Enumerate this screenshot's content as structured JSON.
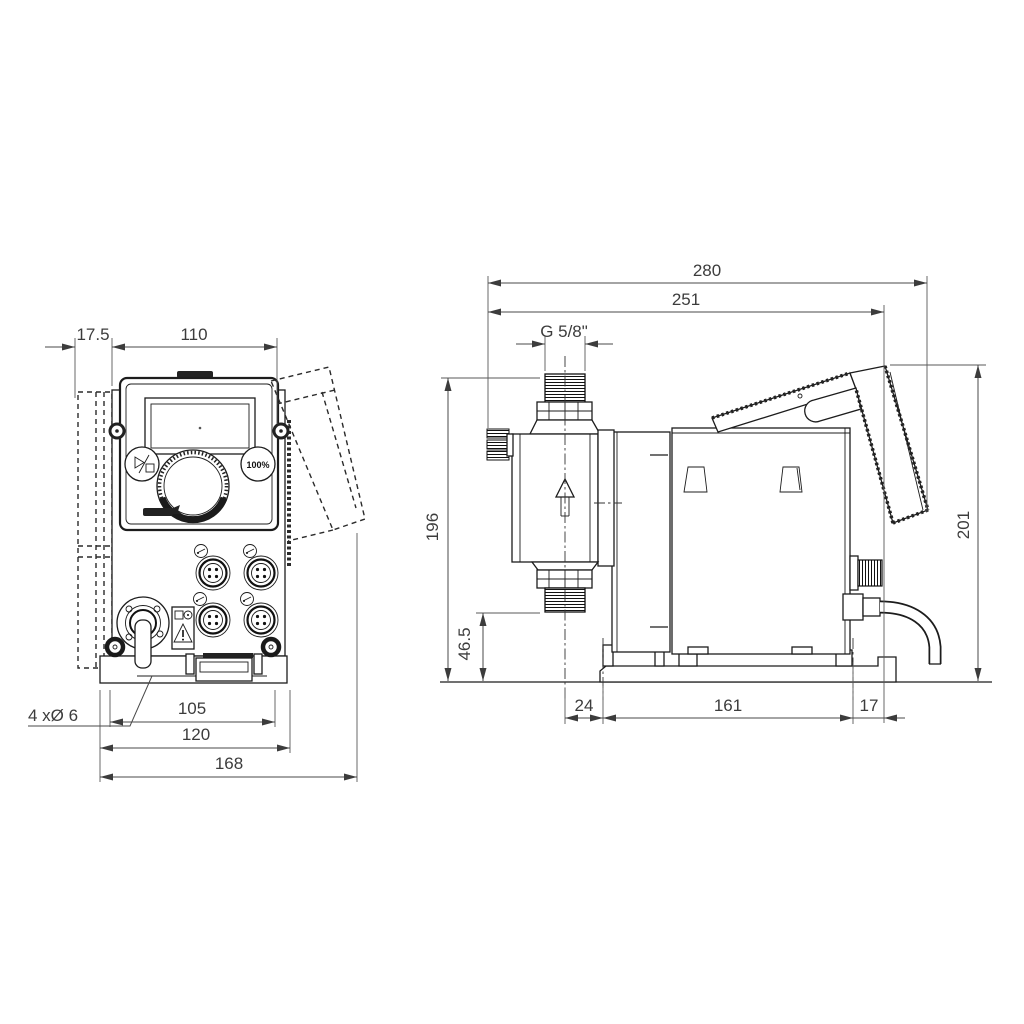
{
  "front_view": {
    "dim_wall_offset": "17.5",
    "dim_body_width": "110",
    "dim_hole_spacing": "105",
    "dim_plate_width": "120",
    "dim_total_width": "168",
    "mounting_holes_label": "4 xØ 6",
    "btn_100_label": "100%"
  },
  "side_view": {
    "dim_total_depth": "280",
    "dim_depth_to_cable": "251",
    "dim_thread_size": "G 5/8\"",
    "dim_height_to_connection": "196",
    "dim_connection_height": "46.5",
    "dim_center_to_hole": "24",
    "dim_hole_spacing": "161",
    "dim_hole_to_edge": "17",
    "dim_total_height": "201"
  },
  "icons": {
    "start_stop_button": "start-stop-icon",
    "percent_button": "hundred-percent-button",
    "warning": "warning-triangle-icon",
    "flow": "flow-arrow-icon",
    "brand": "grundfos-logo",
    "dial": "control-dial-knob",
    "connectors": "m12-connector-socket",
    "cable_gland": "cable-gland",
    "mounting_plate": "wall-mounting-plate"
  }
}
